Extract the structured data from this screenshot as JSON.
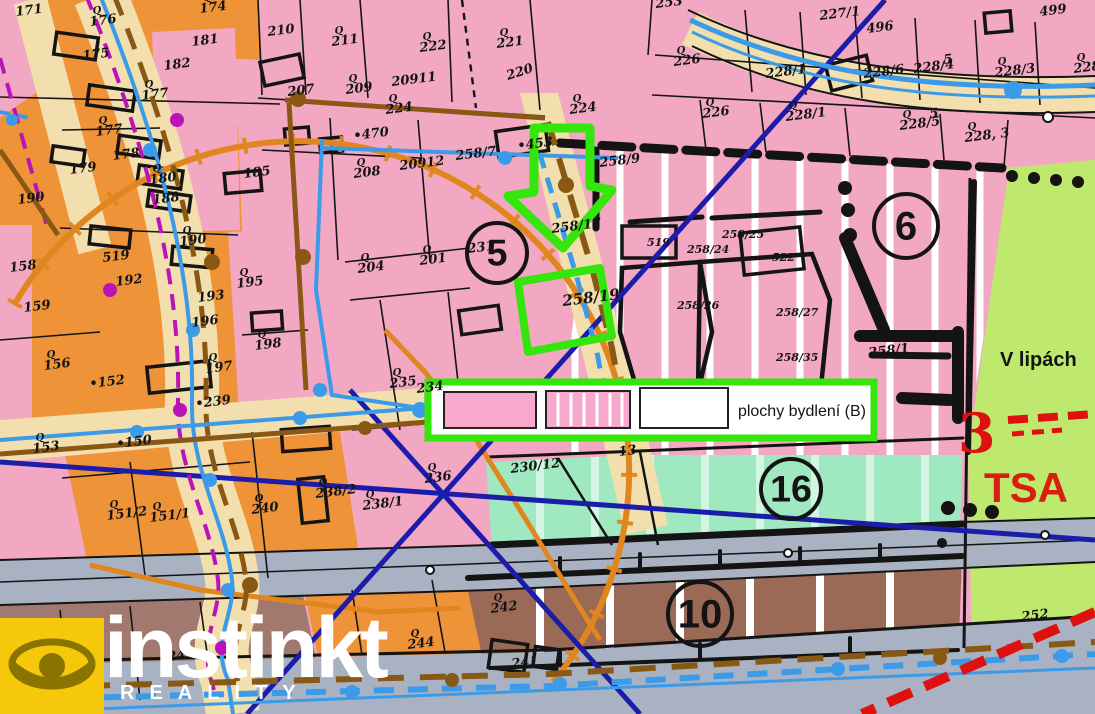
{
  "colors": {
    "pink": "#f2a7c3",
    "pink_light": "#f6b9d0",
    "orange": "#ef9338",
    "orange_road_line": "#e0861f",
    "beige_road": "#f2dfad",
    "gray_road": "#a9b2c2",
    "mint": "#9fe8c0",
    "mint_stripe": "#d2f6e3",
    "green_zone": "#bfe86e",
    "brown_zone": "#9a6a56",
    "mauve_zone": "#a1796e",
    "navy": "#1c1caa",
    "water_blue": "#3b9be8",
    "utility_brown": "#8a5815",
    "magenta": "#b913b9",
    "highlight_green": "#35e60d",
    "red": "#e01010",
    "black": "#141414",
    "white": "#ffffff",
    "watermark_yellow": "#f6c80b"
  },
  "legend": {
    "label": "plochy bydlení (B)"
  },
  "watermark": {
    "brand": "instinkt",
    "subtitle": "REALITY"
  },
  "annotations": {
    "street_name": "V lipách",
    "tsa": "TSA",
    "red_mark": "3"
  },
  "circled_numbers": [
    {
      "n": "5",
      "x": 497,
      "y": 253,
      "r": 30
    },
    {
      "n": "6",
      "x": 906,
      "y": 226,
      "r": 32
    },
    {
      "n": "16",
      "x": 791,
      "y": 489,
      "r": 30
    },
    {
      "n": "10",
      "x": 700,
      "y": 614,
      "r": 32
    }
  ],
  "map_labels": [
    {
      "t": "171",
      "x": 16,
      "y": 16
    },
    {
      "t": "176",
      "x": 90,
      "y": 26,
      "q": 1
    },
    {
      "t": "175",
      "x": 83,
      "y": 60
    },
    {
      "t": "174",
      "x": 200,
      "y": 13,
      "q": 1
    },
    {
      "t": "182",
      "x": 164,
      "y": 70
    },
    {
      "t": "181",
      "x": 192,
      "y": 46
    },
    {
      "t": "177",
      "x": 142,
      "y": 100,
      "q": 1
    },
    {
      "t": "177",
      "x": 96,
      "y": 136,
      "q": 1
    },
    {
      "t": "178",
      "x": 113,
      "y": 160
    },
    {
      "t": "179",
      "x": 70,
      "y": 174
    },
    {
      "t": "180",
      "x": 150,
      "y": 184,
      "q": 1
    },
    {
      "t": "188",
      "x": 153,
      "y": 204
    },
    {
      "t": "190",
      "x": 18,
      "y": 204
    },
    {
      "t": "185",
      "x": 244,
      "y": 178
    },
    {
      "t": "190",
      "x": 180,
      "y": 246,
      "q": 1
    },
    {
      "t": "519",
      "x": 103,
      "y": 262
    },
    {
      "t": "192",
      "x": 116,
      "y": 286
    },
    {
      "t": "158",
      "x": 10,
      "y": 272
    },
    {
      "t": "159",
      "x": 24,
      "y": 312
    },
    {
      "t": "193",
      "x": 198,
      "y": 302
    },
    {
      "t": "195",
      "x": 237,
      "y": 288,
      "q": 1
    },
    {
      "t": "196",
      "x": 192,
      "y": 327
    },
    {
      "t": "198",
      "x": 255,
      "y": 350,
      "q": 1
    },
    {
      "t": "197",
      "x": 206,
      "y": 373,
      "q": 1
    },
    {
      "t": "156",
      "x": 44,
      "y": 370,
      "q": 1
    },
    {
      "t": "•152",
      "x": 90,
      "y": 388
    },
    {
      "t": "153",
      "x": 33,
      "y": 453,
      "q": 1
    },
    {
      "t": "•150",
      "x": 117,
      "y": 448
    },
    {
      "t": "151/2",
      "x": 107,
      "y": 520,
      "q": 1
    },
    {
      "t": "151/1",
      "x": 150,
      "y": 522,
      "q": 1
    },
    {
      "t": "240",
      "x": 252,
      "y": 514,
      "q": 1
    },
    {
      "t": "•239",
      "x": 196,
      "y": 408
    },
    {
      "t": "210",
      "x": 268,
      "y": 36
    },
    {
      "t": "211",
      "x": 332,
      "y": 46,
      "q": 1
    },
    {
      "t": "222",
      "x": 420,
      "y": 52,
      "q": 1
    },
    {
      "t": "221",
      "x": 497,
      "y": 48,
      "q": 1
    },
    {
      "t": "220",
      "x": 508,
      "y": 80,
      "r": -18
    },
    {
      "t": "207",
      "x": 288,
      "y": 96
    },
    {
      "t": "209",
      "x": 346,
      "y": 94,
      "q": 1
    },
    {
      "t": "20911",
      "x": 392,
      "y": 86
    },
    {
      "t": "224",
      "x": 386,
      "y": 114,
      "q": 1
    },
    {
      "t": "•470",
      "x": 354,
      "y": 140
    },
    {
      "t": "20912",
      "x": 400,
      "y": 170
    },
    {
      "t": "208",
      "x": 354,
      "y": 178,
      "q": 1
    },
    {
      "t": "204",
      "x": 358,
      "y": 273,
      "q": 1
    },
    {
      "t": "201",
      "x": 420,
      "y": 265,
      "q": 1
    },
    {
      "t": "258/7",
      "x": 456,
      "y": 160
    },
    {
      "t": "•453",
      "x": 518,
      "y": 150
    },
    {
      "t": "224",
      "x": 570,
      "y": 114,
      "q": 1
    },
    {
      "t": "258/9",
      "x": 600,
      "y": 167
    },
    {
      "t": "258/17",
      "x": 552,
      "y": 233
    },
    {
      "t": "258/19",
      "x": 563,
      "y": 306,
      "s": 15
    },
    {
      "t": "231",
      "x": 468,
      "y": 253
    },
    {
      "t": "253",
      "x": 656,
      "y": 8
    },
    {
      "t": "226",
      "x": 674,
      "y": 66,
      "q": 1
    },
    {
      "t": "227/1",
      "x": 820,
      "y": 20
    },
    {
      "t": "496",
      "x": 867,
      "y": 33
    },
    {
      "t": "228/1",
      "x": 766,
      "y": 78
    },
    {
      "t": "228/6",
      "x": 864,
      "y": 78
    },
    {
      "t": "228/4",
      "x": 914,
      "y": 73
    },
    {
      "t": "5",
      "x": 944,
      "y": 64
    },
    {
      "t": "228/3",
      "x": 995,
      "y": 77,
      "q": 1
    },
    {
      "t": "228/2",
      "x": 1074,
      "y": 73,
      "q": 1
    },
    {
      "t": "499",
      "x": 1040,
      "y": 16
    },
    {
      "t": "226",
      "x": 703,
      "y": 118,
      "q": 1
    },
    {
      "t": "228/1",
      "x": 786,
      "y": 121,
      "q": 1
    },
    {
      "t": "228/5",
      "x": 900,
      "y": 130,
      "q": 1
    },
    {
      "t": "5",
      "x": 930,
      "y": 118
    },
    {
      "t": "228, 3",
      "x": 965,
      "y": 142,
      "q": 1
    },
    {
      "t": "235",
      "x": 390,
      "y": 388,
      "q": 1
    },
    {
      "t": "234",
      "x": 417,
      "y": 393
    },
    {
      "t": "236",
      "x": 425,
      "y": 483,
      "q": 1
    },
    {
      "t": "238/2",
      "x": 316,
      "y": 498,
      "q": 1
    },
    {
      "t": "238/1",
      "x": 363,
      "y": 510,
      "q": 1
    },
    {
      "t": "230/12",
      "x": 511,
      "y": 473
    },
    {
      "t": "13",
      "x": 619,
      "y": 456
    },
    {
      "t": "519",
      "x": 647,
      "y": 246,
      "s": 11,
      "r": 0
    },
    {
      "t": "522",
      "x": 772,
      "y": 261,
      "s": 11,
      "r": 0
    },
    {
      "t": "258/25",
      "x": 722,
      "y": 238,
      "s": 11,
      "r": 0
    },
    {
      "t": "258/24",
      "x": 687,
      "y": 253,
      "s": 11,
      "r": 0
    },
    {
      "t": "258/26",
      "x": 677,
      "y": 309,
      "s": 11,
      "r": 0
    },
    {
      "t": "258/27",
      "x": 776,
      "y": 316,
      "s": 11,
      "r": 0
    },
    {
      "t": "258/35",
      "x": 776,
      "y": 361,
      "s": 11,
      "r": 0
    },
    {
      "t": "258/1",
      "x": 869,
      "y": 357
    },
    {
      "t": "244",
      "x": 408,
      "y": 649,
      "q": 1
    },
    {
      "t": "242",
      "x": 491,
      "y": 613,
      "q": 1
    },
    {
      "t": "241",
      "x": 512,
      "y": 668
    },
    {
      "t": "247",
      "x": 168,
      "y": 661
    },
    {
      "t": "252",
      "x": 1022,
      "y": 621
    }
  ]
}
